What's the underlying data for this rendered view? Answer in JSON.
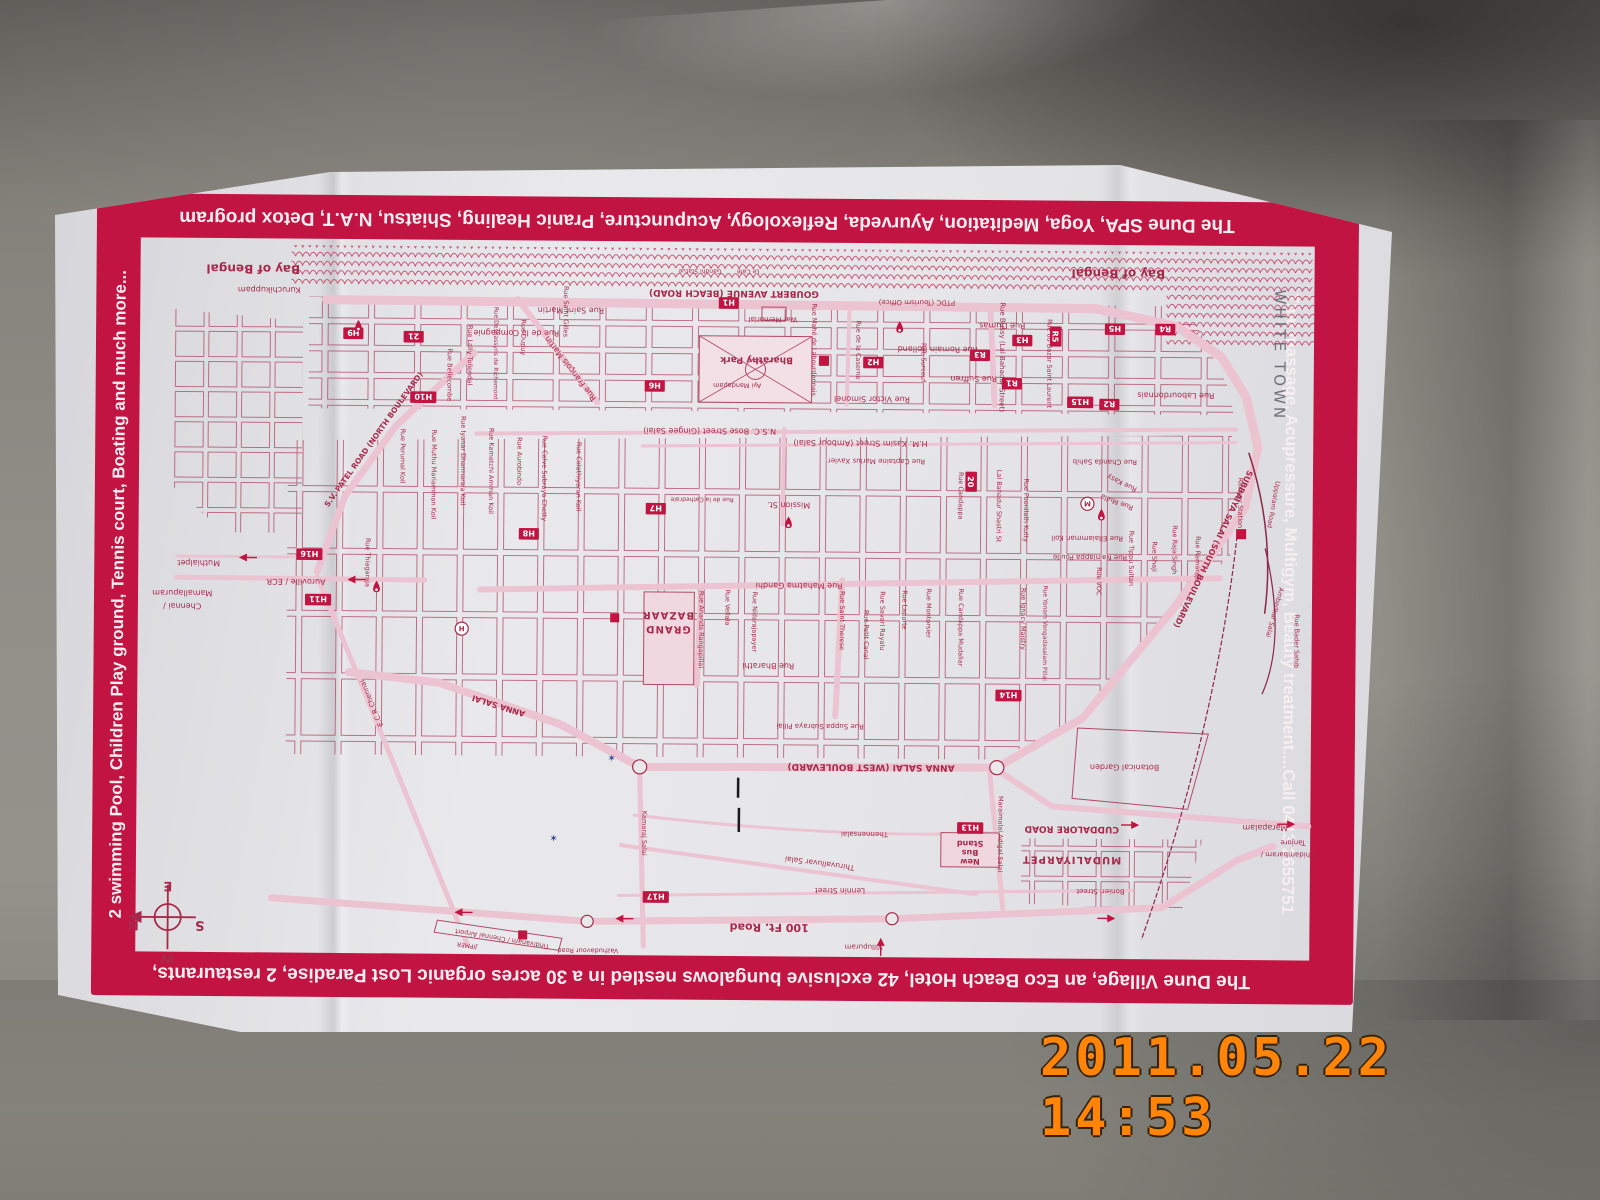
{
  "photo": {
    "date_stamp": "2011.05.22 14:53"
  },
  "border": {
    "accent_color": "#c21442",
    "top_text": "The Dune SPA, Yoga, Meditation, Ayurveda, Reflexology, Acupuncture, Pranic Healing, Shiatsu, N.A.T, Detox program",
    "bottom_text": "The Dune Village, an Eco Beach Hotel, 42 exclusive bungalows nestled in a 30 acres organic Lost Paradise, 2 restaurants,",
    "left_text": "2 swimming Pool, Children Play ground, Tennis court, Boating and much more...",
    "right_text": "Thai massage, Acupressure, Multigym, Beauty treatment....Call 0413 2655751"
  },
  "map": {
    "ink": "#a8294b",
    "accent": "#c21442",
    "labels": [
      {
        "t": "Bay of Bengal",
        "x": 112,
        "y": 26,
        "s": 12,
        "b": 1
      },
      {
        "t": "Bay of Bengal",
        "x": 972,
        "y": 24,
        "s": 12,
        "b": 1
      },
      {
        "t": "Gandhi Statue",
        "x": 556,
        "y": 27,
        "s": 6
      },
      {
        "t": "Le Café",
        "x": 604,
        "y": 27,
        "s": 6
      },
      {
        "t": "GOUBERT AVENUE (BEACH ROAD)",
        "x": 590,
        "y": 48,
        "s": 9,
        "b": 1
      },
      {
        "t": "Kuruchikuppam",
        "x": 128,
        "y": 48,
        "s": 8
      },
      {
        "t": "PTDC (Tourism Office)",
        "x": 772,
        "y": 56,
        "s": 7
      },
      {
        "t": "War Memorial",
        "x": 629,
        "y": 74,
        "s": 7
      },
      {
        "t": "Rue Dumas",
        "x": 857,
        "y": 78,
        "s": 8
      },
      {
        "t": "Rue Saint Martin",
        "x": 428,
        "y": 66,
        "s": 8
      },
      {
        "t": "Rue de la Compagnie",
        "x": 374,
        "y": 89,
        "s": 8
      },
      {
        "t": "Rue Mahé de Labourdonnais",
        "x": 668,
        "y": 106,
        "r": 90,
        "s": 6.5
      },
      {
        "t": "Rue de la Caserne",
        "x": 712,
        "y": 106,
        "r": 90,
        "s": 6.5
      },
      {
        "t": "Bharathy Park",
        "x": 613,
        "y": 114,
        "s": 9,
        "b": 1
      },
      {
        "t": "Ayi Mandapam",
        "x": 594,
        "y": 140,
        "s": 6.5
      },
      {
        "t": "Rue Victor Simonel",
        "x": 728,
        "y": 152,
        "s": 8
      },
      {
        "t": "Rue Romain Rolland",
        "x": 793,
        "y": 102,
        "s": 8
      },
      {
        "t": "Rue Suffren",
        "x": 829,
        "y": 131,
        "s": 8
      },
      {
        "t": "Rue Surcouf",
        "x": 777,
        "y": 118,
        "r": 90,
        "s": 6.5
      },
      {
        "t": "Rue Bussy (Lal Bahadur Street)",
        "x": 855,
        "y": 112,
        "r": 90,
        "s": 7
      },
      {
        "t": "Rue du Bazar Saint Laurent",
        "x": 902,
        "y": 118,
        "r": 90,
        "s": 6.5
      },
      {
        "t": "Rue Labourdonnais",
        "x": 1030,
        "y": 146,
        "s": 8
      },
      {
        "t": "WHITE TOWN",
        "x": 1128,
        "y": 108,
        "r": 90,
        "s": 15,
        "ls": 3,
        "c": "#70707a"
      },
      {
        "t": "Rue Lally Tollendal",
        "x": 326,
        "y": 114,
        "r": 90,
        "s": 6.5
      },
      {
        "t": "Rue Desbassyns de Richemont",
        "x": 352,
        "y": 112,
        "r": 90,
        "s": 6
      },
      {
        "t": "Rue Dupuy",
        "x": 379,
        "y": 96,
        "r": 90,
        "s": 6.5
      },
      {
        "t": "Rue Saint Gilles",
        "x": 421,
        "y": 70,
        "r": 90,
        "s": 6.5
      },
      {
        "t": "Rue François Martin",
        "x": 430,
        "y": 125,
        "r": 232,
        "s": 8
      },
      {
        "t": "Rue Bellecombe",
        "x": 306,
        "y": 134,
        "r": 90,
        "s": 6.5
      },
      {
        "t": "S.V. PATEL ROAD (NORTH BOULEVARD)",
        "x": 235,
        "y": 200,
        "r": 305,
        "s": 7.5,
        "b": 1
      },
      {
        "t": "Rue Perumal Koil",
        "x": 260,
        "y": 215,
        "r": 90,
        "s": 6.5
      },
      {
        "t": "Rue Muthu Mariamman Koil",
        "x": 291,
        "y": 233,
        "r": 90,
        "s": 6.5
      },
      {
        "t": "Rue Iyanar Dharmaraja Koil",
        "x": 320,
        "y": 219,
        "r": 90,
        "s": 6.5
      },
      {
        "t": "Rue Kamatchi Amman Koil",
        "x": 348,
        "y": 229,
        "r": 90,
        "s": 6.5
      },
      {
        "t": "Rue Aurobindo",
        "x": 376,
        "y": 219,
        "r": 90,
        "s": 6.5
      },
      {
        "t": "Rue Calve Subraya Chetty",
        "x": 401,
        "y": 236,
        "r": 90,
        "s": 6.5
      },
      {
        "t": "Rue Calathiyaran Koil",
        "x": 435,
        "y": 234,
        "r": 90,
        "s": 6.5
      },
      {
        "t": "Rue Thiagaraja",
        "x": 226,
        "y": 321,
        "r": 90,
        "s": 6.5
      },
      {
        "t": "N.S.C. Bose Street (Gingee Salai)",
        "x": 567,
        "y": 185,
        "s": 8
      },
      {
        "t": "H.M. Kasim Street (Ambour Salai)",
        "x": 717,
        "y": 196,
        "s": 8
      },
      {
        "t": "Rue Captaine Marius Xavier",
        "x": 733,
        "y": 214,
        "s": 7
      },
      {
        "t": "Mission St.",
        "x": 646,
        "y": 258,
        "s": 8
      },
      {
        "t": "Rue de la Cathedrale",
        "x": 560,
        "y": 254,
        "s": 6
      },
      {
        "t": "Rue Candappa",
        "x": 815,
        "y": 250,
        "r": 90,
        "s": 6.5
      },
      {
        "t": "Lal Bahadur Shastri St",
        "x": 853,
        "y": 260,
        "r": 90,
        "s": 6.5
      },
      {
        "t": "Rue Poonilath Kutty",
        "x": 880,
        "y": 264,
        "r": 90,
        "s": 6.5
      },
      {
        "t": "GRAND",
        "x": 527,
        "y": 382,
        "s": 10,
        "b": 1,
        "ls": 1
      },
      {
        "t": "BAZAAR",
        "x": 527,
        "y": 368,
        "s": 10,
        "b": 1,
        "ls": 1
      },
      {
        "t": "Rue Ananda Rangapillai",
        "x": 558,
        "y": 385,
        "r": 90,
        "s": 6.5
      },
      {
        "t": "Rue Vellala",
        "x": 584,
        "y": 363,
        "r": 90,
        "s": 6.5
      },
      {
        "t": "Rue Nidarajapayer",
        "x": 611,
        "y": 377,
        "r": 90,
        "s": 6.5
      },
      {
        "t": "Rue Mahatma Gandhi",
        "x": 657,
        "y": 338,
        "s": 8
      },
      {
        "t": "Rue Saint Therese",
        "x": 698,
        "y": 375,
        "r": 90,
        "s": 6.5
      },
      {
        "t": "Rue Petit Canal",
        "x": 722,
        "y": 389,
        "r": 90,
        "s": 6.5
      },
      {
        "t": "Rue Savari Rayalu",
        "x": 738,
        "y": 375,
        "r": 90,
        "s": 6.5
      },
      {
        "t": "Rue Laporte",
        "x": 760,
        "y": 364,
        "r": 90,
        "s": 6.5
      },
      {
        "t": "Rue Montorsier",
        "x": 784,
        "y": 367,
        "r": 90,
        "s": 6.5
      },
      {
        "t": "Rue Candappa Mudaliar",
        "x": 816,
        "y": 381,
        "r": 90,
        "s": 6.5
      },
      {
        "t": "Rue Ignacy Maistry",
        "x": 878,
        "y": 372,
        "r": 90,
        "s": 6.5
      },
      {
        "t": "Rue Yanam Vengadasalam Pillai",
        "x": 900,
        "y": 386,
        "r": 90,
        "s": 6
      },
      {
        "t": "Rue Bharathi",
        "x": 627,
        "y": 418,
        "s": 8
      },
      {
        "t": "Rue Suppa Subraya Pillai",
        "x": 679,
        "y": 478,
        "s": 7
      },
      {
        "t": "Rue Chanda Sahib",
        "x": 960,
        "y": 213,
        "s": 7
      },
      {
        "t": "Rue Kasy",
        "x": 978,
        "y": 234,
        "r": 205,
        "s": 7
      },
      {
        "t": "Rue Mulla",
        "x": 973,
        "y": 253,
        "r": 200,
        "s": 7
      },
      {
        "t": "Rue Ellaiamman Koil",
        "x": 943,
        "y": 289,
        "s": 7
      },
      {
        "t": "Rue Nainiappa Poulle",
        "x": 946,
        "y": 308,
        "s": 7
      },
      {
        "t": "Rue VOC",
        "x": 953,
        "y": 334,
        "r": 90,
        "s": 6.5
      },
      {
        "t": "Rue Tippu Sultan",
        "x": 985,
        "y": 311,
        "r": 90,
        "s": 6.5
      },
      {
        "t": "Rue Shaji",
        "x": 1008,
        "y": 309,
        "r": 90,
        "s": 6.5
      },
      {
        "t": "Rue Raja Singh",
        "x": 1028,
        "y": 302,
        "r": 90,
        "s": 6.5
      },
      {
        "t": "Rue Ramaraja",
        "x": 1051,
        "y": 311,
        "r": 90,
        "s": 6.5
      },
      {
        "t": "Rue Bader Sahib",
        "x": 1150,
        "y": 392,
        "r": 90,
        "s": 6.5
      },
      {
        "t": "SUBBAIYA SALAI (SOUTH BOULEVARD)",
        "x": 1066,
        "y": 300,
        "r": 115,
        "s": 8,
        "b": 1
      },
      {
        "t": "Railway Station",
        "x": 1093,
        "y": 255,
        "r": 90,
        "s": 6.5
      },
      {
        "t": "Uppalam Road",
        "x": 1126,
        "y": 256,
        "r": 100,
        "s": 6.5
      },
      {
        "t": "Ambedkar Salai",
        "x": 1128,
        "y": 363,
        "r": 105,
        "s": 6.5
      },
      {
        "t": "ANNA SALAI (WEST BOULEVARD)",
        "x": 730,
        "y": 518,
        "s": 9,
        "b": 1
      },
      {
        "t": "ANNA SALAI",
        "x": 360,
        "y": 460,
        "r": 197,
        "s": 8,
        "b": 1
      },
      {
        "t": "Kamaraj Salai",
        "x": 503,
        "y": 588,
        "r": 90,
        "s": 6.5
      },
      {
        "t": "Thennensalai",
        "x": 724,
        "y": 585,
        "s": 7
      },
      {
        "t": "Thiruvalluvar Salai",
        "x": 680,
        "y": 614,
        "r": 187,
        "s": 7.5
      },
      {
        "t": "Lennin Street",
        "x": 700,
        "y": 641,
        "s": 7.5
      },
      {
        "t": "100 Ft. Road",
        "x": 630,
        "y": 677,
        "s": 11,
        "b": 1
      },
      {
        "t": "Maraimalai Adigal Salai",
        "x": 857,
        "y": 586,
        "r": 90,
        "s": 6.5
      },
      {
        "t": "Stand",
        "x": 829,
        "y": 593,
        "s": 8,
        "b": 1
      },
      {
        "t": "Bus",
        "x": 829,
        "y": 602,
        "s": 8,
        "b": 1
      },
      {
        "t": "New",
        "x": 829,
        "y": 611,
        "s": 8,
        "b": 1
      },
      {
        "t": "CUDDALORE ROAD",
        "x": 930,
        "y": 578,
        "s": 9,
        "b": 1
      },
      {
        "t": "MUDALIYARPET",
        "x": 930,
        "y": 608,
        "s": 10,
        "b": 1,
        "ls": 1
      },
      {
        "t": "Botanical Garden",
        "x": 982,
        "y": 516,
        "s": 8
      },
      {
        "t": "Bonieri Street",
        "x": 959,
        "y": 640,
        "s": 7
      },
      {
        "t": "Marapalam",
        "x": 1122,
        "y": 575,
        "s": 8
      },
      {
        "t": "Tanjore",
        "x": 1150,
        "y": 590,
        "s": 7
      },
      {
        "t": "Chidambaram /",
        "x": 1145,
        "y": 602,
        "s": 7
      },
      {
        "t": "Muthialpet",
        "x": 60,
        "y": 320,
        "s": 8
      },
      {
        "t": "Auroville / ECR",
        "x": 157,
        "y": 338,
        "s": 8
      },
      {
        "t": "Mamallapuram",
        "x": 44,
        "y": 350,
        "s": 8
      },
      {
        "t": "Chennai /",
        "x": 44,
        "y": 363,
        "s": 8
      },
      {
        "t": "E.C.R Chennai",
        "x": 235,
        "y": 460,
        "r": 247,
        "s": 7
      },
      {
        "t": "Vazhudavour Road",
        "x": 450,
        "y": 703,
        "s": 6.5
      },
      {
        "t": "Tindivanam / Chennai Airport",
        "x": 365,
        "y": 692,
        "r": 189,
        "s": 6.5
      },
      {
        "t": "JIPMER",
        "x": 330,
        "y": 699,
        "r": 189,
        "s": 6
      },
      {
        "t": "Villupuram",
        "x": 724,
        "y": 697,
        "s": 7
      },
      {
        "t": "✶",
        "x": 472,
        "y": 517,
        "r": 0,
        "s": 10,
        "c": "#3a4a96"
      },
      {
        "t": "✶",
        "x": 415,
        "y": 597,
        "r": 0,
        "s": 10,
        "c": "#3a4a96"
      },
      {
        "t": "E",
        "x": 32,
        "y": 640,
        "s": 13,
        "b": 1
      },
      {
        "t": "S",
        "x": 64,
        "y": 679,
        "s": 13,
        "b": 1
      },
      {
        "t": "N",
        "x": -2,
        "y": 679,
        "s": 13,
        "b": 1
      },
      {
        "t": "W",
        "x": 32,
        "y": 712,
        "s": 13,
        "b": 1
      }
    ],
    "markers": [
      {
        "t": "H1",
        "x": 585,
        "y": 60
      },
      {
        "t": "H2",
        "x": 729,
        "y": 118
      },
      {
        "t": "H3",
        "x": 877,
        "y": 95
      },
      {
        "t": "H5",
        "x": 969,
        "y": 83
      },
      {
        "t": "H6",
        "x": 512,
        "y": 143
      },
      {
        "t": "H7",
        "x": 514,
        "y": 265
      },
      {
        "t": "H8",
        "x": 388,
        "y": 291
      },
      {
        "t": "H9",
        "x": 212,
        "y": 93
      },
      {
        "t": "H10",
        "x": 282,
        "y": 156
      },
      {
        "t": "H11",
        "x": 179,
        "y": 358
      },
      {
        "t": "H13",
        "x": 829,
        "y": 580
      },
      {
        "t": "H14",
        "x": 866,
        "y": 448
      },
      {
        "t": "H15",
        "x": 935,
        "y": 156
      },
      {
        "t": "H16",
        "x": 170,
        "y": 313
      },
      {
        "t": "H17",
        "x": 517,
        "y": 651
      },
      {
        "t": "R1",
        "x": 867,
        "y": 138
      },
      {
        "t": "R2",
        "x": 964,
        "y": 158
      },
      {
        "t": "R3",
        "x": 835,
        "y": 110
      },
      {
        "t": "R4",
        "x": 1019,
        "y": 83
      },
      {
        "t": "R5",
        "x": 910,
        "y": 91,
        "r": 90
      },
      {
        "t": "20",
        "x": 827,
        "y": 236,
        "r": 90
      },
      {
        "t": "21",
        "x": 272,
        "y": 96
      }
    ],
    "pins": [
      {
        "x": 755,
        "y": 77
      },
      {
        "x": 646,
        "y": 272
      },
      {
        "x": 957,
        "y": 262
      },
      {
        "x": 237,
        "y": 339
      },
      {
        "x": 217,
        "y": 80
      }
    ],
    "squares": [
      {
        "x": 1096,
        "y": 286,
        "w": 10
      },
      {
        "x": 385,
        "y": 690,
        "w": 9
      },
      {
        "x": 474,
        "y": 374,
        "w": 9
      },
      {
        "x": 680,
        "y": 117,
        "w": 10
      }
    ],
    "circles": [
      {
        "t": "M",
        "x": 943,
        "y": 257
      },
      {
        "t": "H",
        "x": 322,
        "y": 386
      }
    ],
    "arrows": [
      {
        "x": 100,
        "y": 317,
        "r": 180
      },
      {
        "x": 208,
        "y": 338,
        "r": 180
      },
      {
        "x": 997,
        "y": 576,
        "r": 0
      },
      {
        "x": 1152,
        "y": 574,
        "r": 0
      },
      {
        "x": 974,
        "y": 669,
        "r": 0
      },
      {
        "x": 741,
        "y": 690,
        "r": 270
      },
      {
        "x": 317,
        "y": 668,
        "r": 180
      },
      {
        "x": 477,
        "y": 673,
        "r": 180
      }
    ]
  }
}
